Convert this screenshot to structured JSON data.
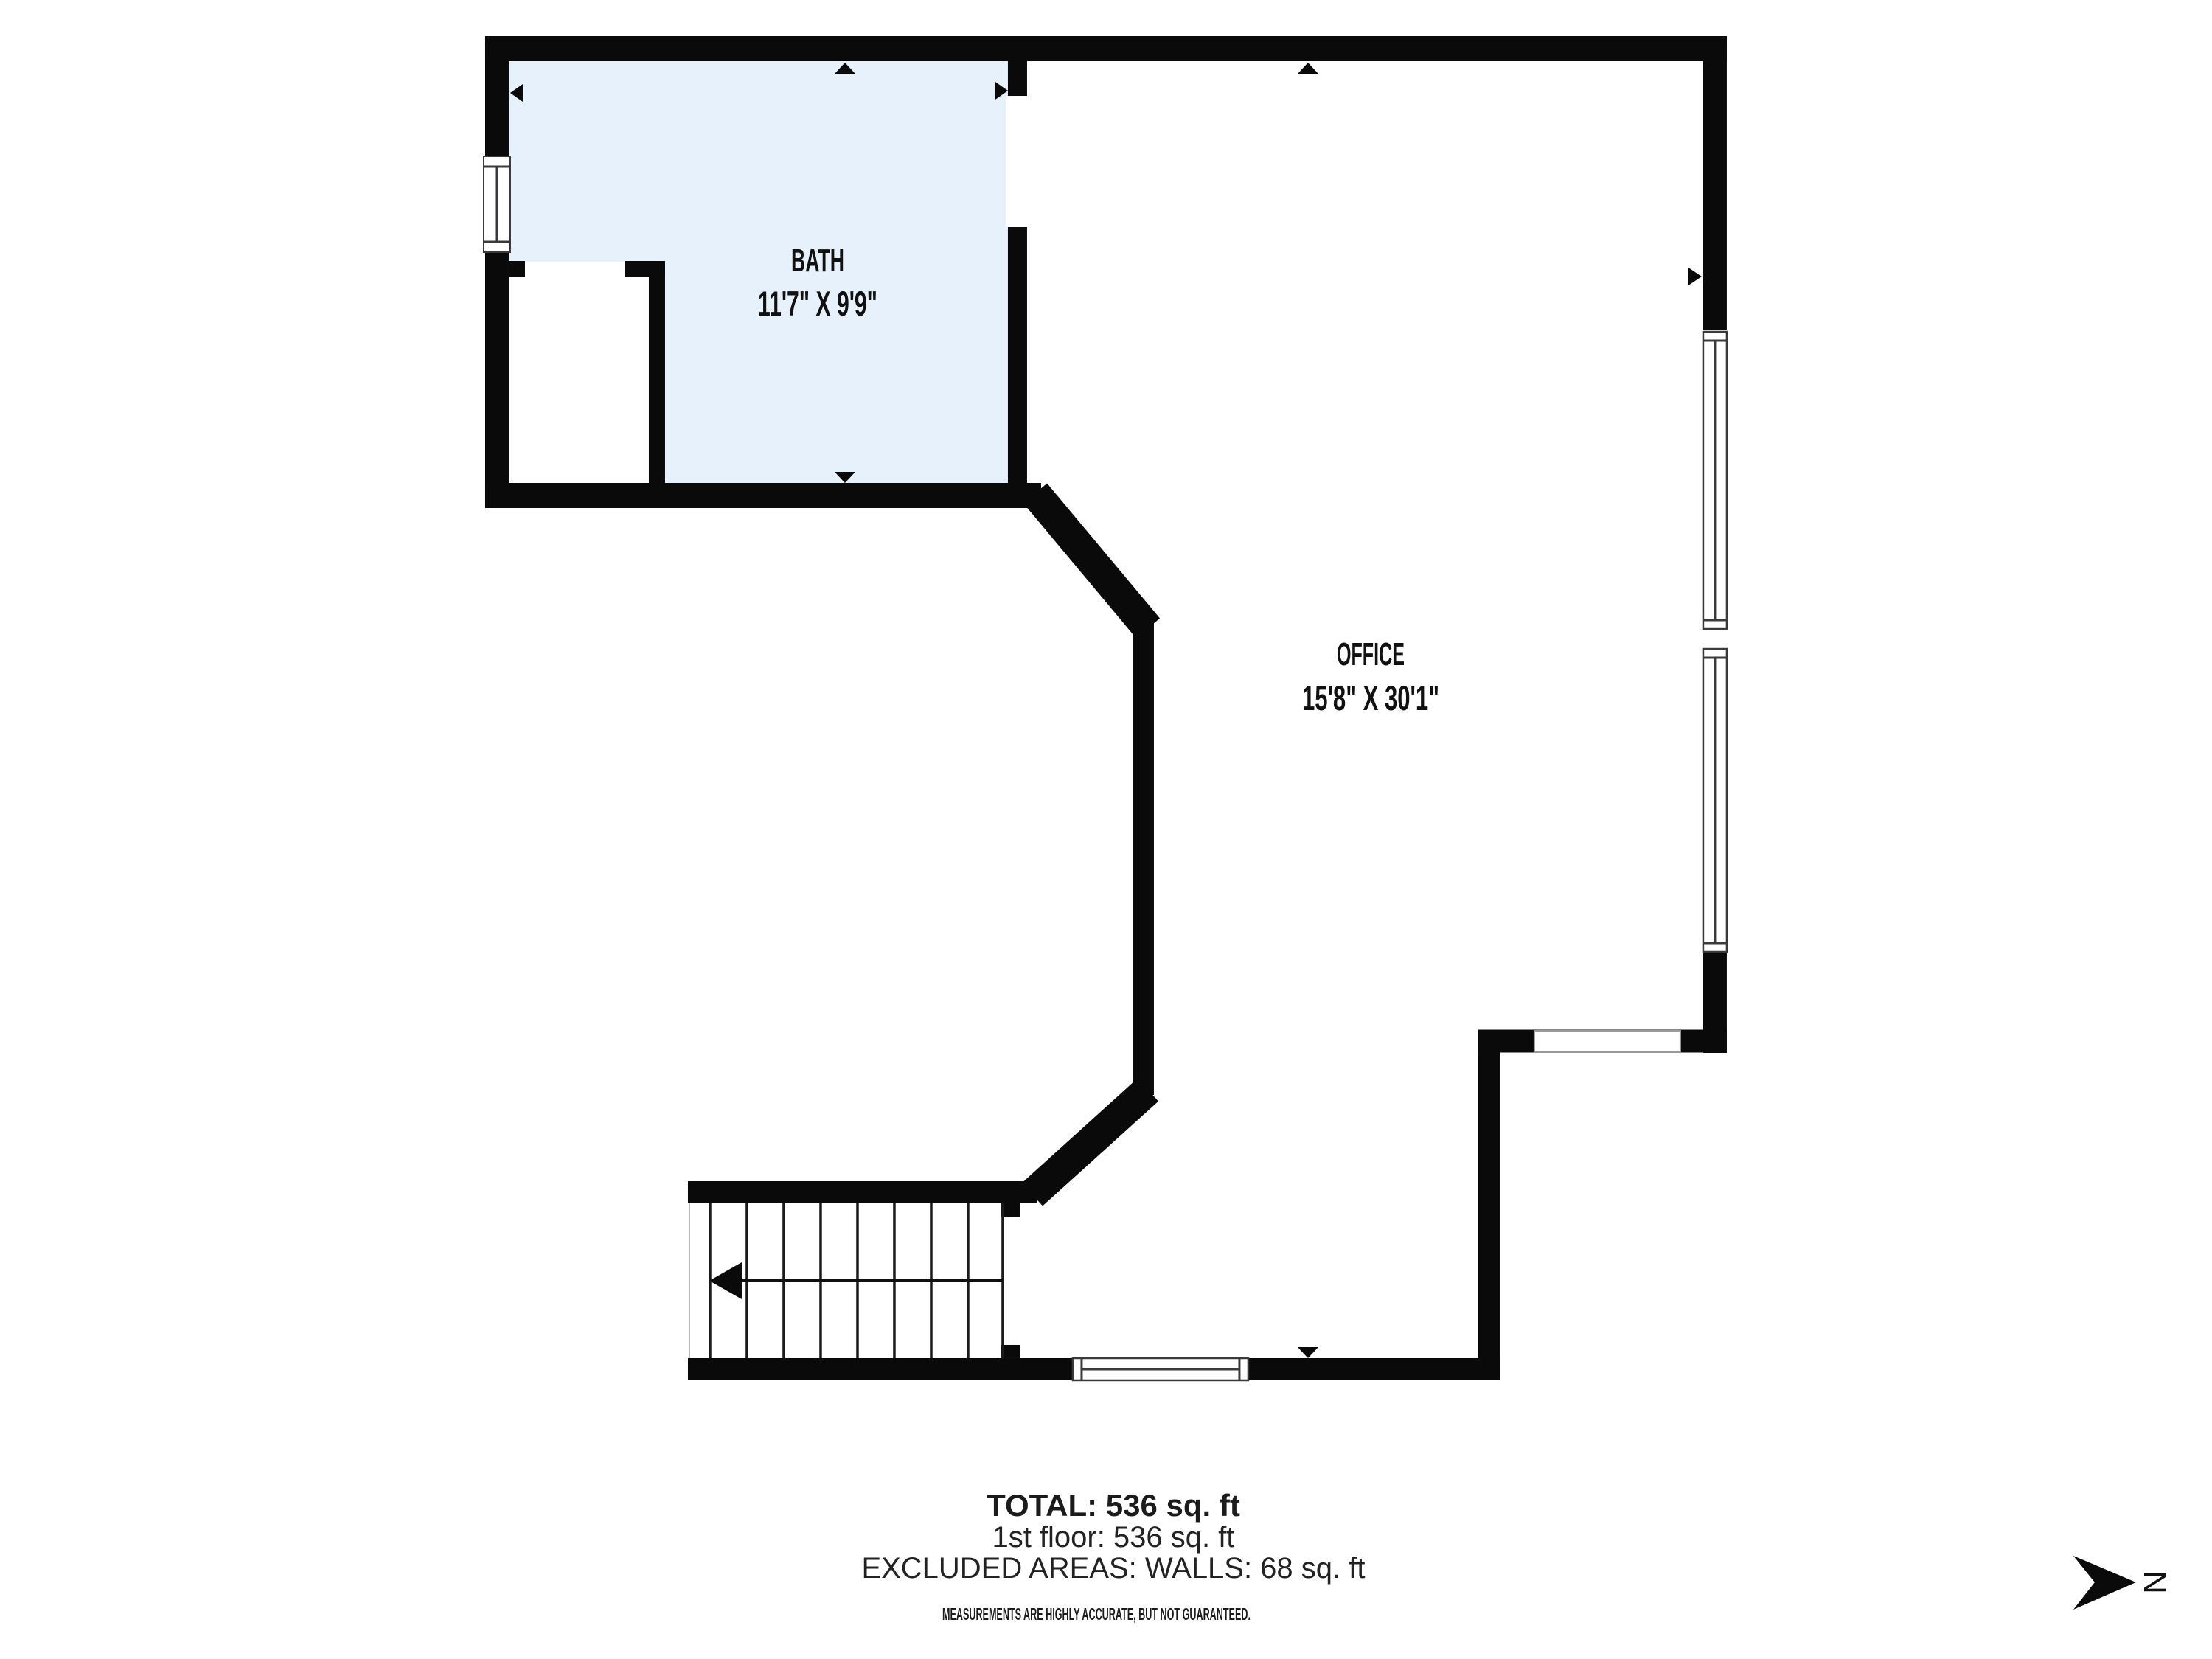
{
  "plan": {
    "rooms": [
      {
        "name": "BATH",
        "dims": "11'7\" X 9'9\""
      },
      {
        "name": "OFFICE",
        "dims": "15'8\" X 30'1\""
      }
    ],
    "compass_label": "N"
  },
  "summary": {
    "total": "TOTAL: 536 sq. ft",
    "floor": "1st floor: 536 sq. ft",
    "excluded": "EXCLUDED AREAS: WALLS: 68 sq. ft",
    "disclaimer": "MEASUREMENTS ARE HIGHLY ACCURATE, BUT NOT GUARANTEED."
  },
  "colors": {
    "wall": "#0a0a0a",
    "bath_fill": "#e7f1fb",
    "window_line": "#3a3a3a"
  }
}
